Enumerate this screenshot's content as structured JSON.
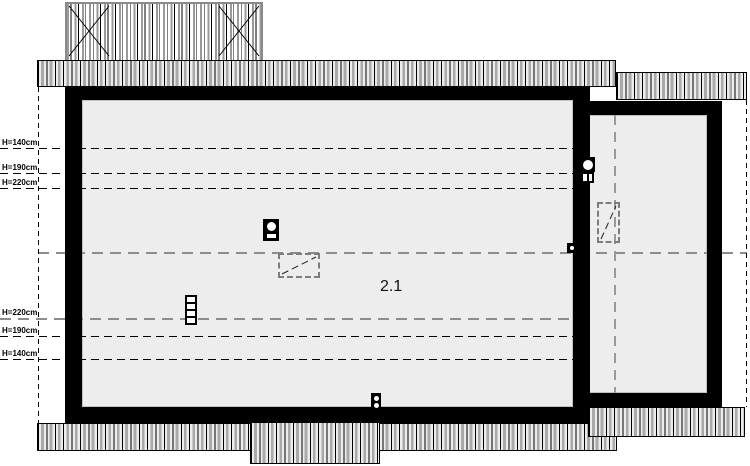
{
  "plan": {
    "room_label": "2.1",
    "height_labels": {
      "top": [
        "H=140cm",
        "H=190cm",
        "H=220cm"
      ],
      "bottom": [
        "H=220cm",
        "H=190cm",
        "H=140cm"
      ]
    },
    "symbol_names": [
      "chimney-icon",
      "skylight-icon",
      "vent-icon",
      "dormer-deck"
    ],
    "colors": {
      "wall": "#000000",
      "floor": "#ededed",
      "hatch_stripe": "#a9a9a9",
      "ridge_dash": "#8c8c8c"
    }
  }
}
